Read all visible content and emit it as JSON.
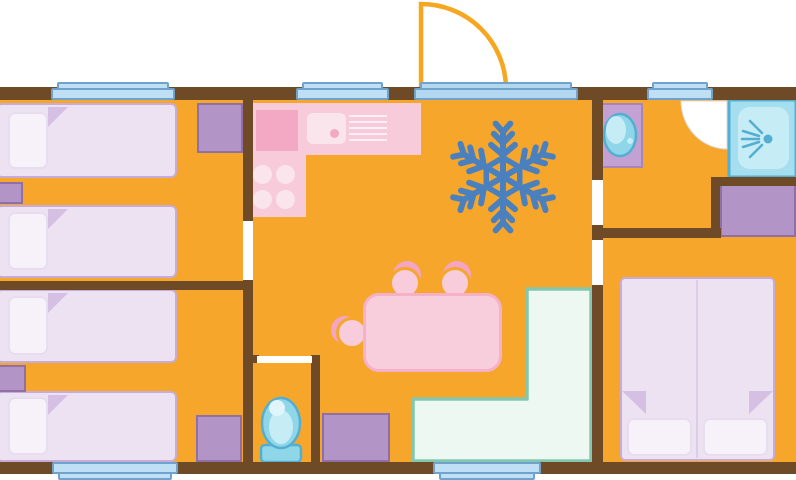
{
  "diagram": {
    "type": "floor-plan",
    "subject": "Holiday mobile-home / caravan floor plan, top-down schematic, no text labels",
    "orientation": "entrance door with swing arc at top center; three windows on the top wall; two windows on the bottom wall",
    "has_text": false
  },
  "palette": {
    "page_bg": "#FFFFFF",
    "floor": "#F6A62B",
    "wall": "#6E4B26",
    "opening_white": "#FFFFFF",
    "window_fill": "#BFE0F4",
    "window_border": "#6FA3CE",
    "threshold_fill": "#B3D7EE",
    "door_stroke": "#F7A71F",
    "swing_border": "#DADADA",
    "bed_fill": "#EDE2F2",
    "bed_border": "#C6ACD6",
    "pillow_fill": "#F7F2FA",
    "pillow_border": "#E8DDEF",
    "fold_fill": "#D5BFE2",
    "purple_fill": "#B294C6",
    "purple_border": "#8F6FA6",
    "counter_purple_fill": "#C3A2D3",
    "counter_purple_border": "#A685BC",
    "pink": "#F7CBDA",
    "pink_dark": "#F3A9C4",
    "pink_light": "#FAE5ED",
    "stripe_light": "#FCEFF5",
    "table_fill": "#F9CEDC",
    "table_border": "#F4B1C8",
    "chair_back": "#F3A5C1",
    "chair_front": "#F8CCDB",
    "bench_fill": "#EDF8F2",
    "bench_border": "#84C7B1",
    "blue_fill": "#8FD6E9",
    "blue_border": "#54AED1",
    "blue_light": "#C6EDF5",
    "blue_lighter": "#DFF5FA",
    "shower_fill": "#A5DEEF",
    "snowflake": "#4B80BF",
    "divider": "#DCCDE6"
  },
  "rooms": [
    {
      "name": "bedroom-top-left",
      "furniture": [
        "single-bed",
        "single-bed",
        "nightstand",
        "wardrobe"
      ]
    },
    {
      "name": "bedroom-bottom-left",
      "furniture": [
        "single-bed",
        "single-bed",
        "nightstand",
        "nightstand"
      ]
    },
    {
      "name": "kitchen-living-area",
      "furniture": [
        "l-shaped-kitchen-counter",
        "hob-4-burners",
        "sink",
        "drainer",
        "air-conditioning-snowflake",
        "dining-table",
        "chair",
        "chair",
        "chair",
        "corner-bench",
        "cabinet"
      ]
    },
    {
      "name": "wc",
      "furniture": [
        "toilet"
      ]
    },
    {
      "name": "shower-room",
      "furniture": [
        "washbasin",
        "shower-tray",
        "door-swing"
      ]
    },
    {
      "name": "bedroom-right",
      "furniture": [
        "double-bed",
        "wardrobe"
      ]
    }
  ],
  "openings": {
    "entrance_doors": 1,
    "windows_top_wall": 3,
    "windows_bottom_wall": 2,
    "interior_door_gaps": 4
  }
}
